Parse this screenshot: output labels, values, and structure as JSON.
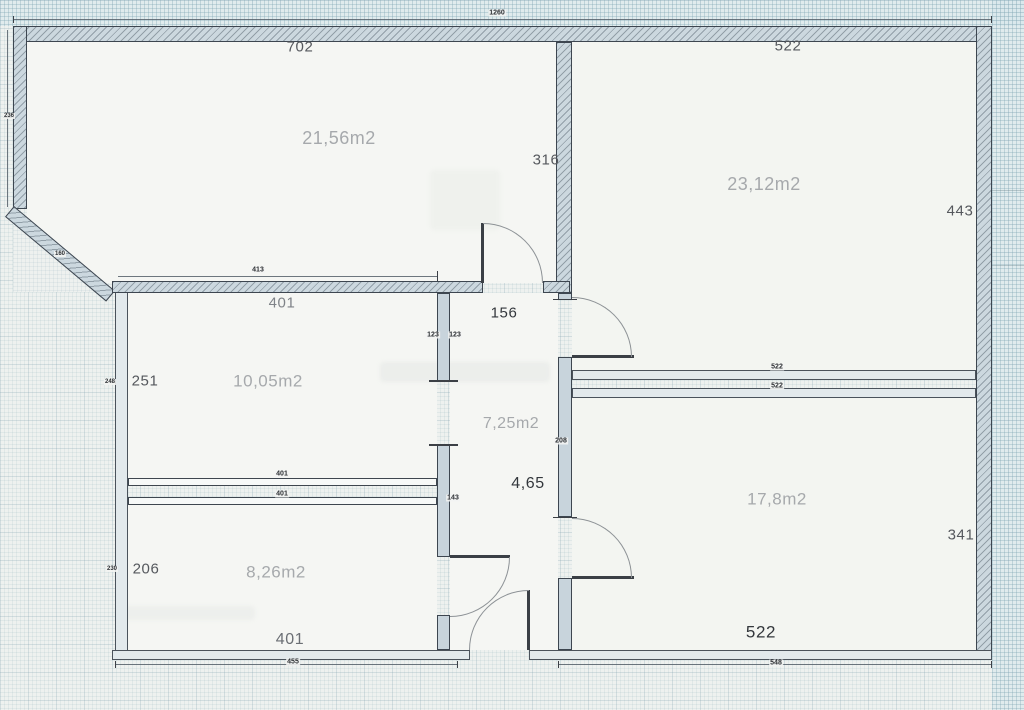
{
  "plan": {
    "rooms": {
      "room_top_left_area": "21,56m2",
      "room_top_right_area": "23,12m2",
      "room_mid_left_area": "10,05m2",
      "room_bottom_left_area": "8,26m2",
      "room_bottom_right_area": "17,8m2",
      "hallway_area": "7,25m2",
      "entry_hall_label": "4,65"
    },
    "dims": {
      "top_left_width": "702",
      "top_right_width": "522",
      "wall_316": "316",
      "right_upper_height": "443",
      "right_lower_height": "341",
      "mid_left_width": "401",
      "hall_width": "156",
      "mid_left_height": "251",
      "bottom_left_height": "206",
      "bottom_left_width": "401",
      "bottom_right_width": "522"
    },
    "tiny_dims": {
      "total_top": "1260",
      "t413": "413",
      "t236": "236",
      "t160": "160",
      "t123a": "123",
      "t123b": "123",
      "t248": "248",
      "t522a": "522",
      "t522b": "522",
      "t208": "208",
      "t401a": "401",
      "t401b": "401",
      "t143": "143",
      "t230": "230",
      "t455": "455",
      "t548": "548"
    },
    "colors": {
      "paper": "#eef1ef",
      "wall_fill": "#ccd8df",
      "wall_edge": "#3d4650",
      "area_label_grey": "#a6a9ac"
    }
  }
}
